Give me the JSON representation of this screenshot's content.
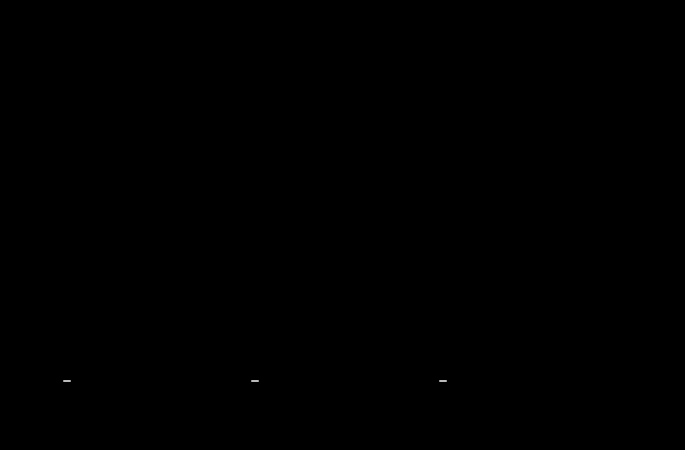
{
  "title": "TIPOLOGÍAS DE VIVIENDAS - PLANTA TIPO",
  "colors": {
    "background": "#000000",
    "pink": "#f6dbdb",
    "green": "#daeedb",
    "blue": "#dbe6f4",
    "common_white": "#f2f2f2",
    "magenta": "#e6007e",
    "dim_line": "#cfcfcf"
  },
  "left_dims": [
    "0.600",
    "0.600",
    "13.800",
    "15.000",
    "1.200"
  ],
  "plans": [
    {
      "variant": "A",
      "color": "#f6dbdb",
      "label": {
        "prefix": "TIPOLOGIA",
        "code": "2D",
        "suffix": "",
        "superficie": "SUPERFICIE NETA 50.20 m²",
        "viviendas": "17 VIVIENDAS"
      },
      "rooms": [
        {
          "num": "4",
          "area": "11.78 m2"
        },
        {
          "num": "9",
          "area": "9.87 m2"
        },
        {
          "num": "5",
          "area": "4.14 m2"
        },
        {
          "num": "6",
          "area": "4.13 m2"
        },
        {
          "num": "8",
          "area": "3.30 m2"
        },
        {
          "num": "3",
          "area": "3.84 m2"
        },
        {
          "num": "2",
          "area": "3.80 m2"
        },
        {
          "num": "7",
          "area": "10.04 m2"
        }
      ],
      "commons": [
        {
          "num": "9"
        },
        {
          "num": "1"
        }
      ],
      "dims": {
        "top_spans": [
          "2.275",
          "2.275"
        ],
        "top_ends": [
          "0.300",
          "0.300",
          "0.300"
        ],
        "bottom": [
          "1.200"
        ]
      }
    },
    {
      "variant": "B",
      "color": "#daeedb",
      "label": {
        "prefix": "TIPOLOGIA",
        "code": "1D",
        "suffix": "",
        "superficie": "SUPERFICIE NETA 40.30 m²",
        "viviendas": "79 VIVIENDAS"
      },
      "rooms": [
        {
          "num": "4",
          "area": "11.78 m2"
        },
        {
          "num": "6",
          "area": "4.13 m2"
        },
        {
          "num": "5",
          "area": "4.14 m2"
        },
        {
          "num": "3",
          "area": "3.84 m2"
        },
        {
          "num": "8",
          "area": "3.30 m2"
        },
        {
          "num": "2",
          "area": "3.80 m2"
        },
        {
          "num": "7",
          "area": "10.04 m2"
        }
      ],
      "commons": [
        {
          "num": "9"
        },
        {
          "num": "1"
        }
      ],
      "dims": {
        "top_spans": [
          "2.275"
        ],
        "top_ends": [
          "0.300",
          "0.300"
        ],
        "bottom": [
          "1.200"
        ]
      }
    },
    {
      "variant": "C",
      "color": "#dbe6f4",
      "label": {
        "prefix": "TIPOLOGIA",
        "code": "2D(A)",
        "suffix": "- Adaptadas para Minusválidos",
        "superficie": "SUPERFICIE NETA 50.95 m²",
        "viviendas": "10 VIVIENDAS"
      },
      "rooms": [
        {
          "num": "4",
          "area": "11.78 m2"
        },
        {
          "num": "9",
          "area": "9.76 m2"
        },
        {
          "num": "6",
          "area": "4.13 m2"
        },
        {
          "num": "5",
          "area": "4.14 m2"
        },
        {
          "num": "3",
          "area": "3.84 m2"
        },
        {
          "num": "8",
          "area": "3.56 m2"
        },
        {
          "num": "2",
          "area": "3.80 m2"
        },
        {
          "num": "7",
          "area": "10.08 m2"
        }
      ],
      "commons": [
        {
          "num": "9"
        },
        {
          "num": "11"
        },
        {
          "num": "10"
        },
        {
          "num": "1"
        }
      ],
      "dims": {
        "top_spans": [
          "2.275",
          "2.275"
        ],
        "top_ends": [
          "0.300",
          "0.300",
          "0.300"
        ],
        "bottom": [
          "1.200",
          "2.375"
        ]
      }
    }
  ],
  "key_plan": {
    "slices": "PPGPPPBGPPPGPPPPGPPPPBPPGPPGPPPPGP"
  },
  "table": {
    "groups": [
      {
        "label": "SUPERFICIES",
        "span": 2
      },
      {
        "label": "VIVIENDAS",
        "span": 4
      },
      {
        "label": "TRASTEROS",
        "span": 3
      },
      {
        "label": "APARCAMIENTO",
        "span": 3
      }
    ],
    "columns": [
      "TOTAL PARCELA (m²)",
      "CONSTRUIDA (m²)",
      "Nº TOTAL",
      "1D",
      "2D",
      "2D (A) *",
      "Nº TOTAL",
      "ÚTIL (m²)",
      "CONSTR. (m²)",
      "Total PLAZAS",
      "Plazas Norm.",
      "Plazas Minusv."
    ],
    "values": [
      "3443.00",
      "1729.88",
      "106",
      "79",
      "17",
      "10",
      "106",
      "684.10",
      "876.80",
      "236",
      "228",
      "8"
    ]
  },
  "note": "* Las tipologías 2D(A) están todas dimensionadas para minusválidos"
}
